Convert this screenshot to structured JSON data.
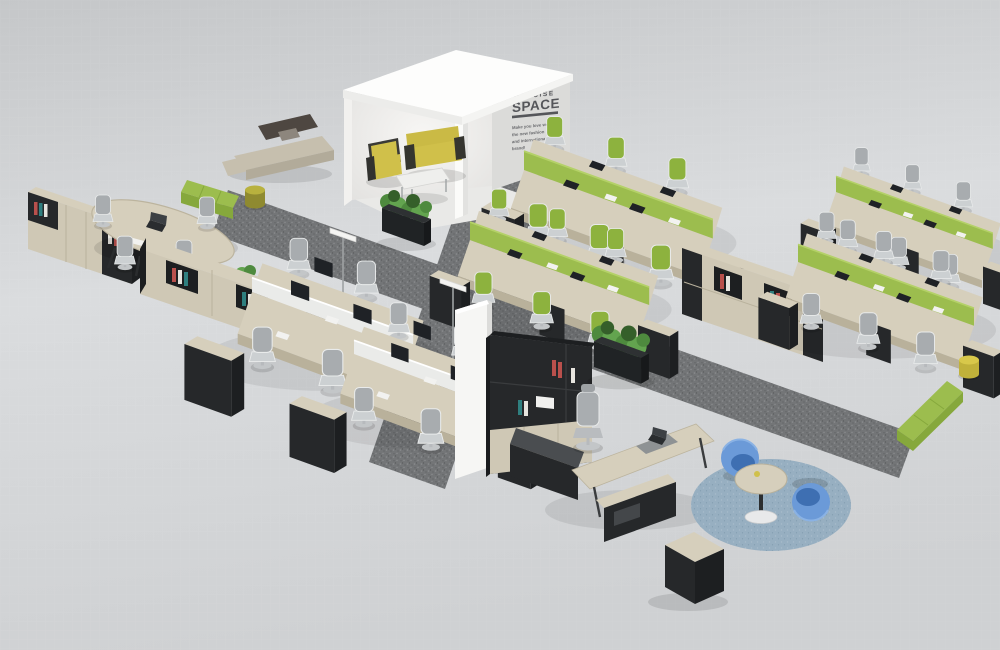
{
  "meta": {
    "scene_title": "CONCISE SPACE office furniture showroom render"
  },
  "room": {
    "brand_line1": "CONCISE",
    "brand_line2": "SPACE",
    "tagline_lines": [
      "Make you love work",
      "the new fashion",
      "and international",
      "brand!"
    ]
  },
  "zones": [
    "reception-room",
    "lounge-sofa-area",
    "conference-area",
    "workstation-cluster-green",
    "workstation-cluster-monitor",
    "storage-credenza",
    "executive-office",
    "coffee-lounge-circle"
  ],
  "colors": {
    "floor_top": "#c5c7c9",
    "floor_mid": "#dadcde",
    "floor_low": "#cfd1d3",
    "carpet": "#737577",
    "carpet_fleck_light": "#8b8d8f",
    "carpet_fleck_dark": "#5c5e60",
    "white_wall": "#fbfbf9",
    "text_wall_face": "#dbdbd9",
    "wall_text": "#55565a",
    "wood": "#d6cfbc",
    "wood_front": "#cfc8b5",
    "wood_dark": "#b9b19b",
    "dark": "#2a2c2e",
    "darker": "#1d1f21",
    "panel_black": "#26282a",
    "green": "#9cbd4e",
    "green_dark": "#86a83c",
    "chair_green": "#8db23e",
    "chair_gray": "#a8acaf",
    "seat_gray": "#ccd0d2",
    "divider_glass": "#eceded",
    "screen_dark": "#1f2226",
    "yellow": "#d0c04a",
    "yellow_dark": "#b5a63a",
    "beige": "#c6bfae",
    "beige_dark": "#b2ab9a",
    "brown": "#4e4741",
    "blue": "#6b9ad8",
    "blue_dark": "#3e6fb2",
    "rug_blue": "#97afc1",
    "plant": "#4e8a3e",
    "plant_light": "#63a44f",
    "plant_dark": "#355f2a",
    "metal": "#9fa2a4",
    "book_red": "#b9504c",
    "book_teal": "#2f7f7f",
    "book_cream": "#e7e5df"
  }
}
